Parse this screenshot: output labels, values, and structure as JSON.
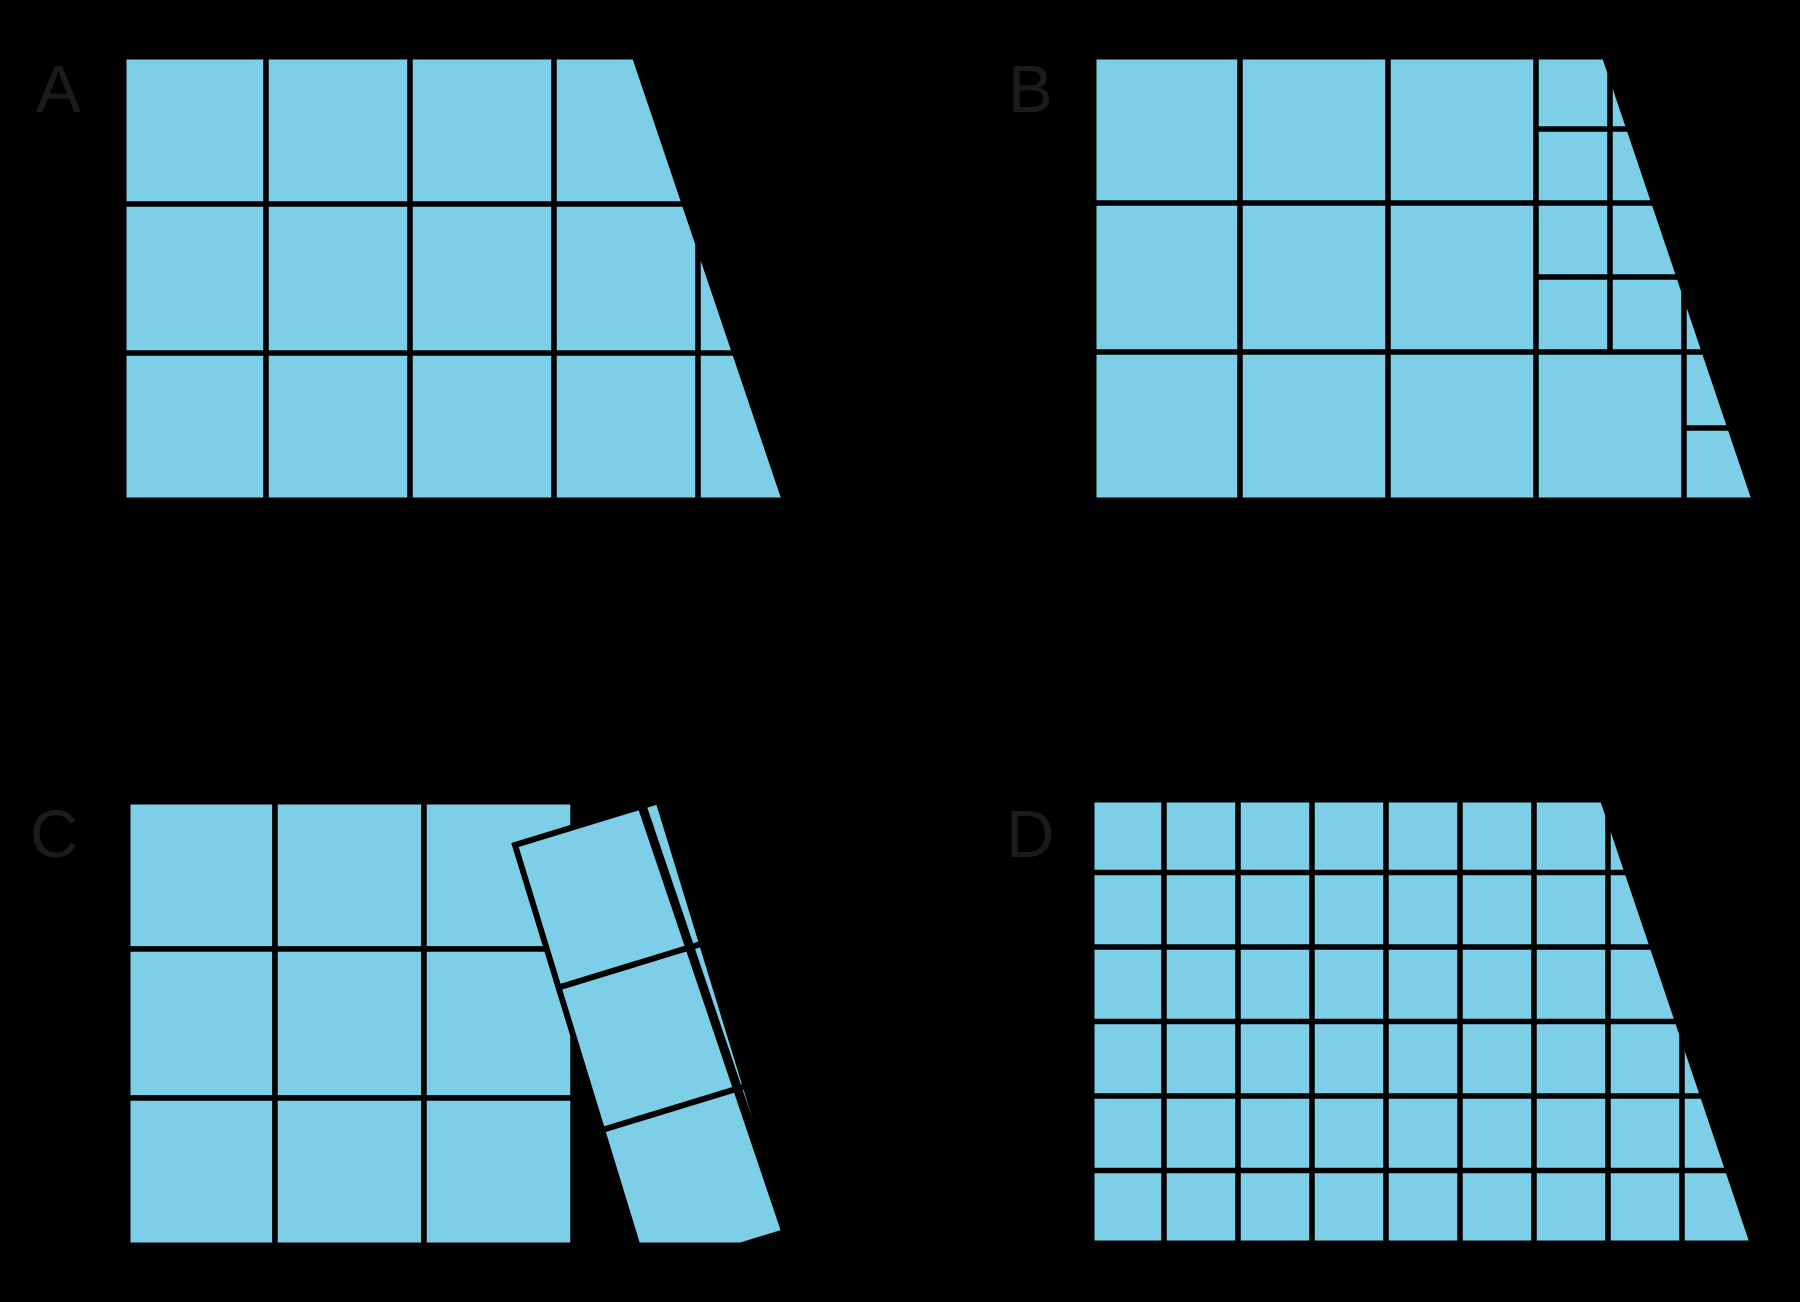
{
  "page": {
    "background_color": "#000000",
    "description": "Four copies of the same trapezoid, labeled A, B, C, and D, each covered with square tiles in a different way"
  },
  "figure": {
    "tile_color": "#7DCFE8",
    "line_color": "#000000",
    "label_color": "#1b1b1b",
    "label_font_size": 67,
    "grid_stroke": 5.5,
    "outline_stroke": 9,
    "trapezoid": {
      "top_width": 514,
      "bottom_width": 665,
      "height": 447
    },
    "shapes": [
      {
        "label": "A",
        "label_pos": [
          36,
          112
        ],
        "origin": [
          122,
          55
        ],
        "kind": "filled-grid",
        "vlines": [
          {
            "x": 144,
            "y1": 0,
            "y2": 447
          },
          {
            "x": 288,
            "y1": 0,
            "y2": 447
          },
          {
            "x": 432,
            "y1": 0,
            "y2": 447
          },
          {
            "x": 576,
            "y1": 0,
            "y2": 447
          }
        ],
        "hlines": [
          {
            "y": 149,
            "x1": 0,
            "x2": 665
          },
          {
            "y": 298,
            "x1": 0,
            "x2": 665
          }
        ]
      },
      {
        "label": "B",
        "label_pos": [
          1008,
          112
        ],
        "origin": [
          1092,
          55
        ],
        "kind": "filled-grid",
        "vlines": [
          {
            "x": 148,
            "y1": 0,
            "y2": 447
          },
          {
            "x": 296,
            "y1": 0,
            "y2": 447
          },
          {
            "x": 444,
            "y1": 0,
            "y2": 447
          },
          {
            "x": 518,
            "y1": 0,
            "y2": 298
          },
          {
            "x": 592,
            "y1": 222,
            "y2": 447
          }
        ],
        "hlines": [
          {
            "y": 148,
            "x1": 0,
            "x2": 665
          },
          {
            "y": 297,
            "x1": 0,
            "x2": 665
          },
          {
            "y": 74,
            "x1": 444,
            "x2": 680
          },
          {
            "y": 222,
            "x1": 444,
            "x2": 680
          },
          {
            "y": 373,
            "x1": 592,
            "x2": 680
          }
        ]
      },
      {
        "label": "C",
        "label_pos": [
          30,
          857
        ],
        "origin": [
          126,
          800
        ],
        "kind": "tiles-with-tilted-strip",
        "tile_grid": {
          "rows": 3,
          "cols": 3,
          "cell": 149
        },
        "strip": {
          "x": 389,
          "y": 45,
          "width": 150,
          "length": 449,
          "angle_deg": -17,
          "divisions": [
            149,
            298
          ]
        }
      },
      {
        "label": "D",
        "label_pos": [
          1006,
          857
        ],
        "origin": [
          1090,
          798
        ],
        "kind": "filled-grid",
        "vlines": [
          {
            "x": 74,
            "y1": 0,
            "y2": 447
          },
          {
            "x": 148,
            "y1": 0,
            "y2": 447
          },
          {
            "x": 222,
            "y1": 0,
            "y2": 447
          },
          {
            "x": 296,
            "y1": 0,
            "y2": 447
          },
          {
            "x": 370,
            "y1": 0,
            "y2": 447
          },
          {
            "x": 444,
            "y1": 0,
            "y2": 447
          },
          {
            "x": 518,
            "y1": 0,
            "y2": 447
          },
          {
            "x": 592,
            "y1": 0,
            "y2": 447
          }
        ],
        "hlines": [
          {
            "y": 74.5,
            "x1": 0,
            "x2": 665
          },
          {
            "y": 149,
            "x1": 0,
            "x2": 665
          },
          {
            "y": 223.5,
            "x1": 0,
            "x2": 665
          },
          {
            "y": 298,
            "x1": 0,
            "x2": 665
          },
          {
            "y": 372.5,
            "x1": 0,
            "x2": 665
          }
        ]
      }
    ]
  }
}
